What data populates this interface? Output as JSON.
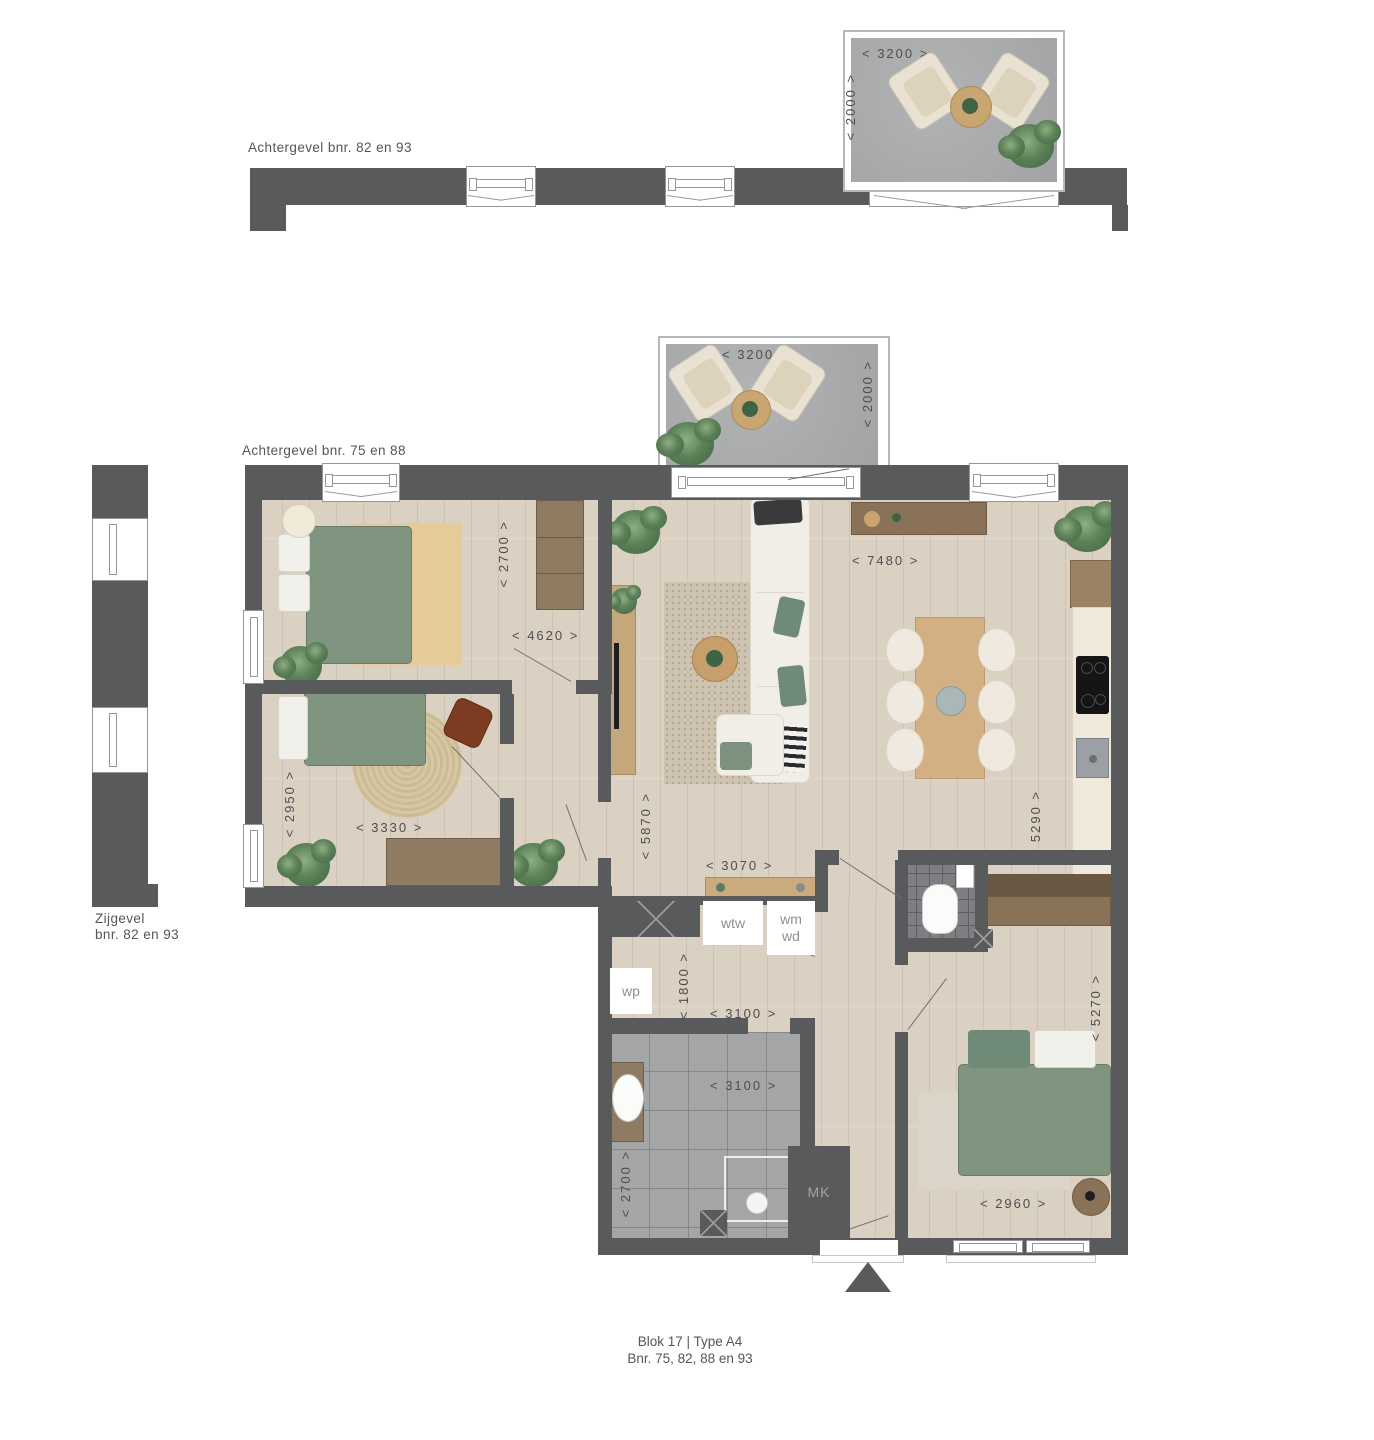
{
  "labels": {
    "top_elevation": "Achtergevel bnr. 82 en 93",
    "mid_elevation": "Achtergevel bnr. 75 en 88",
    "side_elevation_1": "Zijgevel",
    "side_elevation_2": "bnr. 82 en 93",
    "caption_1": "Blok 17 | Type A4",
    "caption_2": "Bnr. 75, 82, 88 en 93"
  },
  "boxes": {
    "wtw": "wtw",
    "wm": "wm",
    "wd": "wd",
    "wp": "wp",
    "mk": "MK"
  },
  "dims": {
    "balcony_top_w": "< 3200 >",
    "balcony_top_d": "< 2000 >",
    "balcony_mid_w": "< 3200 >",
    "balcony_mid_d": "< 2000 >",
    "bedroom1_d": "< 2700 >",
    "bedroom1_w": "< 4620 >",
    "bedroom2_d": "< 2950 >",
    "bedroom2_w": "< 3330 >",
    "living_d": "< 5870 >",
    "living_hall_w": "< 3070 >",
    "kitchen_w": "< 7480 >",
    "kitchen_d": "< 5290 >",
    "tech_d": "< 1800 >",
    "tech_w": "< 3100 >",
    "bath_w": "< 3100 >",
    "bath_d": "< 2700 >",
    "master_d": "< 5270 >",
    "master_w": "< 2960 >"
  },
  "palette": {
    "wall": "#595a5c",
    "wood_floor": "#dbd1c3",
    "tile": "#a3a5a7",
    "concrete": "#a9abad",
    "accent_green": "#7f957f",
    "furniture_wood": "#8f7a62"
  }
}
